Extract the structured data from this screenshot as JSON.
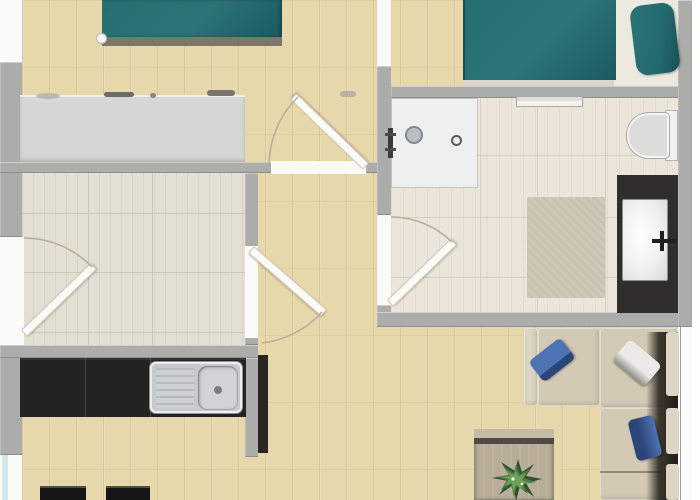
{
  "image": {
    "type": "floor-plan",
    "view": "top-down-3d-render",
    "visible_text": ""
  },
  "colors": {
    "margin_white": "#fdfdfc",
    "wall": "#acacaa",
    "wall_edge": "#8d8d8b",
    "wood_base": "#e7d8ab",
    "tileroom_floor": "#e4dfd3",
    "tileroom_line": "#c5c0b1",
    "bath_floor": "#ebe6d9",
    "bath_tile_line": "#d5cfc0",
    "shower_base": "#eef0f0",
    "shower_border": "#c2c4c2",
    "fixture_dark": "#3a3a38",
    "steel": "#c6cacd",
    "steel_dark": "#9fa3a6",
    "bed_teal": "#266f72",
    "bed_teal_dark": "#1c5a5e",
    "bed_foot": "#7d766b",
    "mattress_light": "#eceadf",
    "dresser": "#d6d6d3",
    "counter_black": "#232321",
    "cabinet_dark": "#2a2520",
    "stool_black": "#161616",
    "stool_edge": "#49523f",
    "vanity_dark": "#2f2e2b",
    "sink_white": "#f4f4f2",
    "rug": "#c9c2b1",
    "sofa": "#d3cab6",
    "sofa_light": "#ddd5c3",
    "sofa_shadow": "#211e18",
    "pillow_blue": "#4e73b2",
    "pillow_blue_dark": "#2c4579",
    "pillow_gray": "#eceae6",
    "pillow_gray_shadow": "#8e8c88",
    "table": "#b7ad99",
    "table_edge": "#4f4b43",
    "plant_dark": "#2e5231",
    "plant_mid": "#4c7a42",
    "plant_light": "#6fa05a",
    "door_leaf": "#fafaf7",
    "door_leaf_edge": "#cfc9b8",
    "arc": "#b5ad96",
    "window_glass": "#cfe8ea",
    "toilet_white": "#f2f2f0",
    "toilet_gray": "#dcdcda"
  },
  "rooms": [
    {
      "id": "bedroom-1",
      "floor": "wood",
      "position": "top-left"
    },
    {
      "id": "bedroom-2",
      "floor": "wood",
      "position": "top-right"
    },
    {
      "id": "bathroom",
      "floor": "tile",
      "position": "middle-right"
    },
    {
      "id": "storage-room",
      "floor": "light-plank",
      "position": "middle-left"
    },
    {
      "id": "open-kitchen-living",
      "floor": "wood",
      "position": "bottom"
    }
  ],
  "furniture": [
    {
      "id": "double-bed-1",
      "room": "bedroom-1",
      "color_ref": "bed_teal"
    },
    {
      "id": "sideboard",
      "room": "bedroom-1",
      "color_ref": "dresser"
    },
    {
      "id": "double-bed-2",
      "room": "bedroom-2",
      "color_ref": "bed_teal"
    },
    {
      "id": "pillow-teal",
      "room": "bedroom-2",
      "color_ref": "bed_teal"
    },
    {
      "id": "shower-tray",
      "room": "bathroom",
      "color_ref": "shower_base"
    },
    {
      "id": "towel-rail",
      "room": "bathroom"
    },
    {
      "id": "toilet",
      "room": "bathroom",
      "color_ref": "toilet_white"
    },
    {
      "id": "vanity-with-sink",
      "room": "bathroom",
      "color_ref": "vanity_dark"
    },
    {
      "id": "bath-rug",
      "room": "bathroom",
      "color_ref": "rug"
    },
    {
      "id": "kitchen-counter",
      "room": "open-kitchen-living",
      "color_ref": "counter_black"
    },
    {
      "id": "kitchen-sink",
      "room": "open-kitchen-living",
      "color_ref": "steel"
    },
    {
      "id": "tall-cabinet",
      "room": "open-kitchen-living",
      "color_ref": "cabinet_dark"
    },
    {
      "id": "bar-stools",
      "count": 2,
      "room": "open-kitchen-living",
      "color_ref": "stool_black"
    },
    {
      "id": "corner-sofa",
      "room": "open-kitchen-living",
      "color_ref": "sofa"
    },
    {
      "id": "cushions-blue",
      "count": 2,
      "color_ref": "pillow_blue"
    },
    {
      "id": "cushion-gray",
      "count": 1,
      "color_ref": "pillow_gray"
    },
    {
      "id": "coffee-table",
      "room": "open-kitchen-living",
      "color_ref": "table"
    },
    {
      "id": "potted-plant",
      "room": "open-kitchen-living",
      "color_ref": "plant_mid"
    }
  ],
  "doors": [
    {
      "id": "entry-door",
      "wall": "left",
      "swings_into": "storage-room"
    },
    {
      "id": "bedroom-1-door",
      "wall": "bedroom-1-south",
      "swings_into": "bedroom-1"
    },
    {
      "id": "storage-door",
      "wall": "storage-east",
      "swings_into": "hall"
    },
    {
      "id": "bathroom-door",
      "wall": "bathroom-west",
      "swings_into": "bathroom"
    }
  ],
  "windows": [
    {
      "id": "window-top-left",
      "wall": "left"
    },
    {
      "id": "window-bottom-left",
      "wall": "left",
      "color_ref": "window_glass"
    },
    {
      "id": "window-living-right",
      "wall": "right"
    }
  ]
}
